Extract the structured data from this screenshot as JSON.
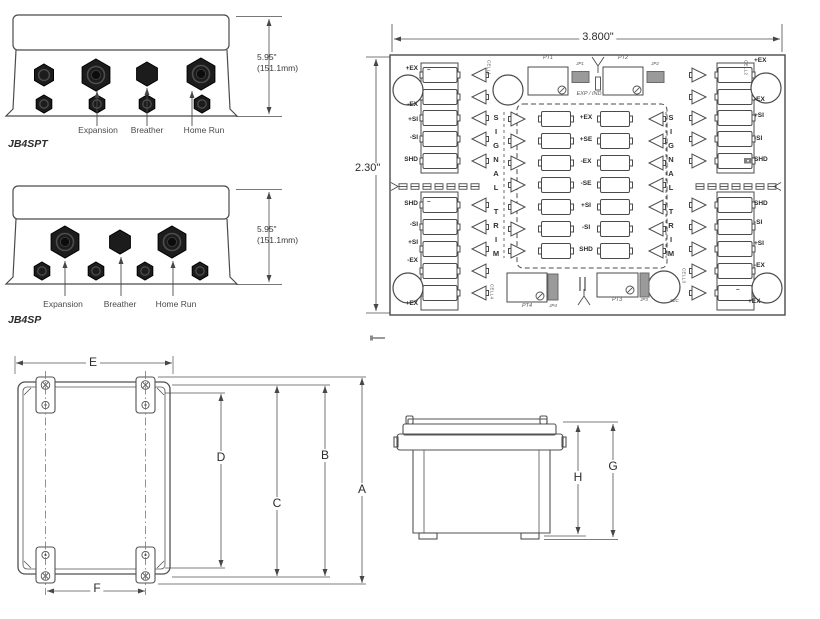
{
  "jb4spt": {
    "model": "JB4SPT",
    "height": "5.95\"",
    "height_mm": "(151.1mm)",
    "port_labels": [
      "Expansion",
      "Breather",
      "Home Run"
    ]
  },
  "jb4sp": {
    "model": "JB4SP",
    "height": "5.95\"",
    "height_mm": "(151.1mm)",
    "port_labels": [
      "Expansion",
      "Breather",
      "Home Run"
    ]
  },
  "pcb": {
    "width": "3.800\"",
    "height": "2.30\"",
    "left_top": [
      "+EX",
      "-EX",
      "+SI",
      "-SI",
      "SHD"
    ],
    "left_bottom": [
      "SHD",
      "-SI",
      "+SI",
      "-EX",
      "+EX"
    ],
    "right_top": [
      "+EX",
      "-EX",
      "+SI",
      "-SI",
      "SHD"
    ],
    "right_bottom": [
      "SHD",
      "-SI",
      "+SI",
      "-EX",
      "+EX"
    ],
    "center": [
      "+EX",
      "+SE",
      "-EX",
      "-SE",
      "+SI",
      "-SI",
      "SHD"
    ],
    "signal": "S\nI\nG\nN\nA\nL",
    "trim": "T\nR\nI\nM",
    "exp_ind": "EXP / IND",
    "cells": [
      "CELL1",
      "CELL2",
      "CELL3",
      "CELL4"
    ],
    "pots": [
      "PT1",
      "PT2",
      "PT3",
      "PT4"
    ],
    "jumpers": [
      "JP1",
      "JP2",
      "JP3",
      "JP4"
    ],
    "s2c": "S2C",
    "minus": "–"
  },
  "enclosure": {
    "dims": {
      "e": "E",
      "f": "F",
      "d": "D",
      "c": "C",
      "b": "B",
      "a": "A"
    }
  },
  "side": {
    "dims": {
      "h": "H",
      "g": "G"
    }
  }
}
